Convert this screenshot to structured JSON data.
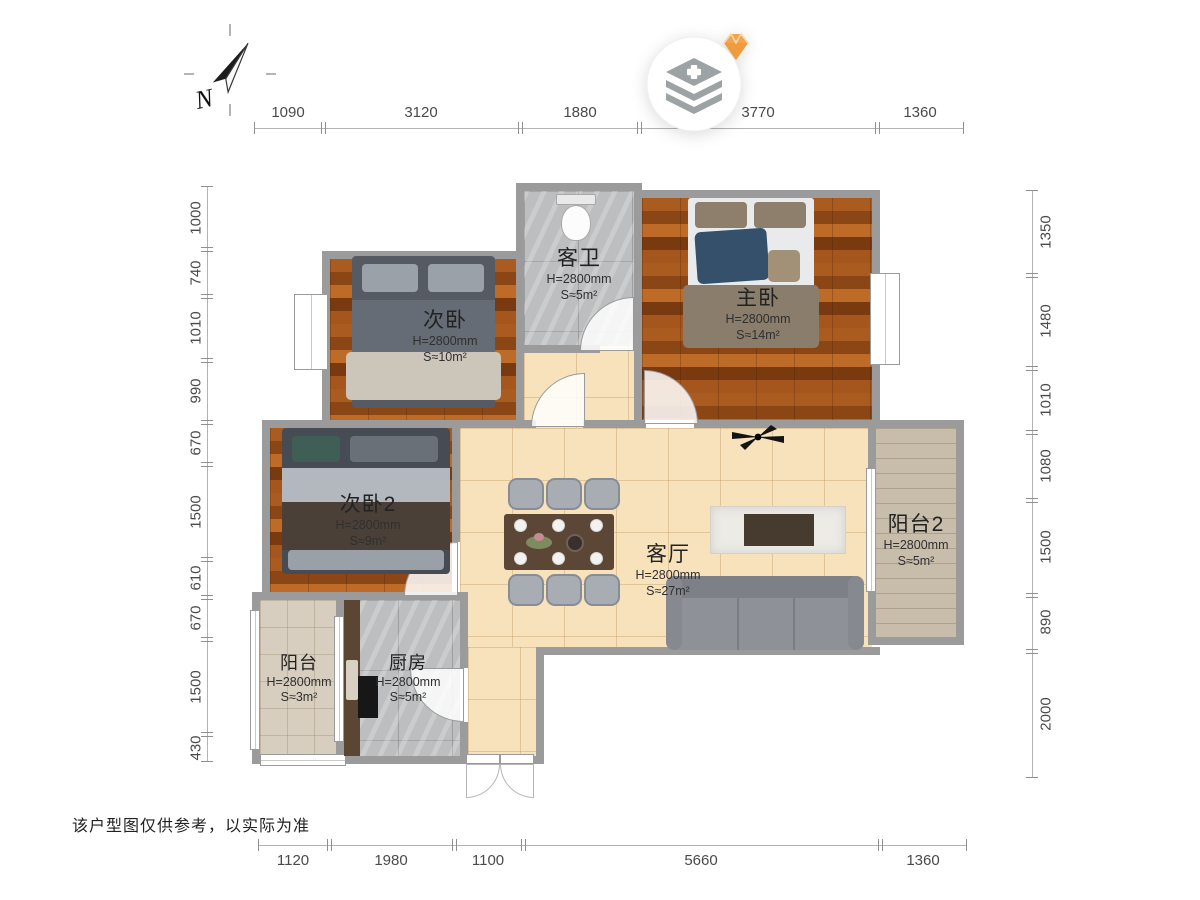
{
  "compass": {
    "label": "N"
  },
  "disclaimer": "该户型图仅供参考，以实际为准",
  "dimensions": {
    "top": [
      "1090",
      "3120",
      "1880",
      "3770",
      "1360"
    ],
    "bottom": [
      "1120",
      "1980",
      "1100",
      "5660",
      "1360"
    ],
    "left": [
      "1000",
      "740",
      "1010",
      "990",
      "670",
      "1500",
      "610",
      "670",
      "1500",
      "430"
    ],
    "right": [
      "1350",
      "1480",
      "1010",
      "1080",
      "1500",
      "890",
      "2000"
    ]
  },
  "rooms": [
    {
      "name": "次卧",
      "ceiling": "H=2800mm",
      "area": "S≈10m²"
    },
    {
      "name": "客卫",
      "ceiling": "H=2800mm",
      "area": "S≈5m²"
    },
    {
      "name": "主卧",
      "ceiling": "H=2800mm",
      "area": "S≈14m²"
    },
    {
      "name": "次卧2",
      "ceiling": "H=2800mm",
      "area": "S≈9m²"
    },
    {
      "name": "客厅",
      "ceiling": "H=2800mm",
      "area": "S≈27m²"
    },
    {
      "name": "阳台2",
      "ceiling": "H=2800mm",
      "area": "S≈5m²"
    },
    {
      "name": "阳台",
      "ceiling": "H=2800mm",
      "area": "S≈3m²"
    },
    {
      "name": "厨房",
      "ceiling": "H=2800mm",
      "area": "S≈5m²"
    }
  ],
  "colors": {
    "wall": "#9b9b9b",
    "wood_floor": "#9c5420",
    "tile_floor": "#bdbebf",
    "living_floor": "#f8e2bc",
    "balcony_floor": "#c8bdab",
    "diamond_accent": "#f2a44e",
    "icon_gray": "#9da2a4"
  }
}
